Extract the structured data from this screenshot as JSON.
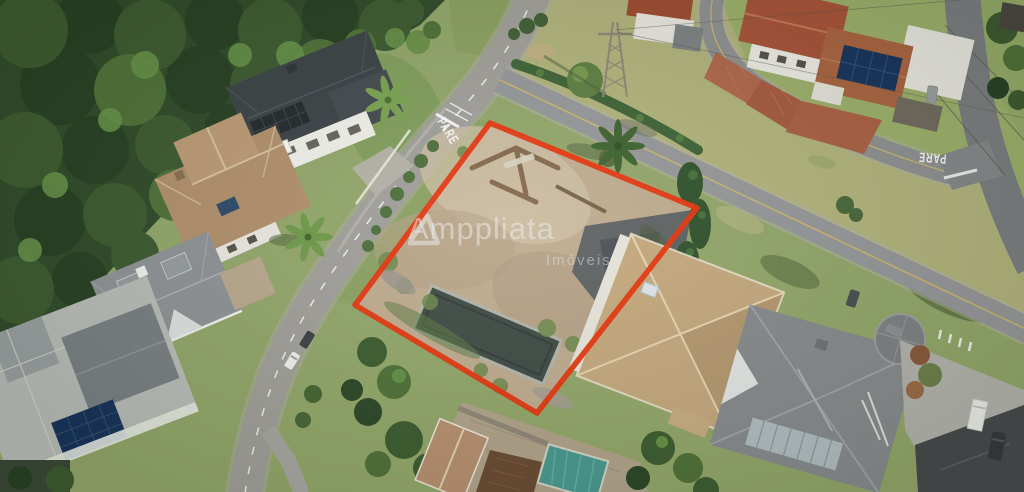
{
  "watermark": {
    "brand": "Amppliata",
    "tagline": "Imóveis",
    "icon": "triangle-outline-logo-icon"
  },
  "road_markings": {
    "pare_left": "PARE",
    "pare_right": "PARE"
  },
  "colors": {
    "lot_outline": "#e8350e",
    "watermark_text": "rgba(235,235,235,0.55)",
    "road_asphalt": "#a19f9b",
    "road_asphalt_mid": "#96979a",
    "road_asphalt_dark": "#7b7d80",
    "grass_base": "#93a76a",
    "grass_dry": "#b2b47c",
    "forest": "#2f4a29",
    "lot_dirt": "#c0ac90",
    "pool_cover": "#479a92",
    "solar_panel": "#16325c",
    "roof_dark": "#3b4246",
    "roof_brown": "#b2906c",
    "roof_tan": "#c6a97e",
    "roof_gray": "#888b8e",
    "roof_red": "#a85138",
    "road_marking_white": "#ffffff",
    "center_line_yellow": "#cfbd6a"
  }
}
